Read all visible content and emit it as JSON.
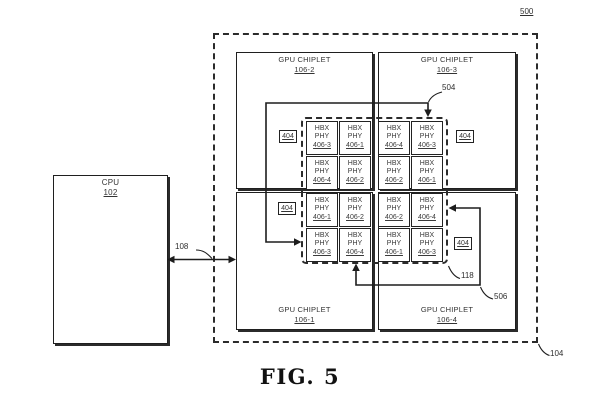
{
  "figure": {
    "caption": "FIG. 5",
    "diagram_ref": "500",
    "system_boundary_ref": "104",
    "cpu_bus_ref": "108",
    "route_a_ref": "504",
    "route_b_ref": "506",
    "crosslink_ref": "118"
  },
  "cpu": {
    "title": "CPU",
    "ref": "102"
  },
  "chiplets": {
    "top_left": {
      "title": "GPU CHIPLET",
      "ref": "106-2"
    },
    "top_right": {
      "title": "GPU CHIPLET",
      "ref": "106-3"
    },
    "bottom_left": {
      "title": "GPU CHIPLET",
      "ref": "106-1"
    },
    "bottom_right": {
      "title": "GPU CHIPLET",
      "ref": "106-4"
    }
  },
  "phy_block": {
    "line1": "HBX",
    "line2": "PHY"
  },
  "phy_refs_rows": [
    [
      "406-3",
      "406-1",
      "406-4",
      "406-3"
    ],
    [
      "406-4",
      "406-2",
      "406-2",
      "406-1"
    ],
    [
      "406-1",
      "406-2",
      "406-2",
      "406-4"
    ],
    [
      "406-3",
      "406-4",
      "406-1",
      "406-3"
    ]
  ],
  "phy_group_ref": "404"
}
